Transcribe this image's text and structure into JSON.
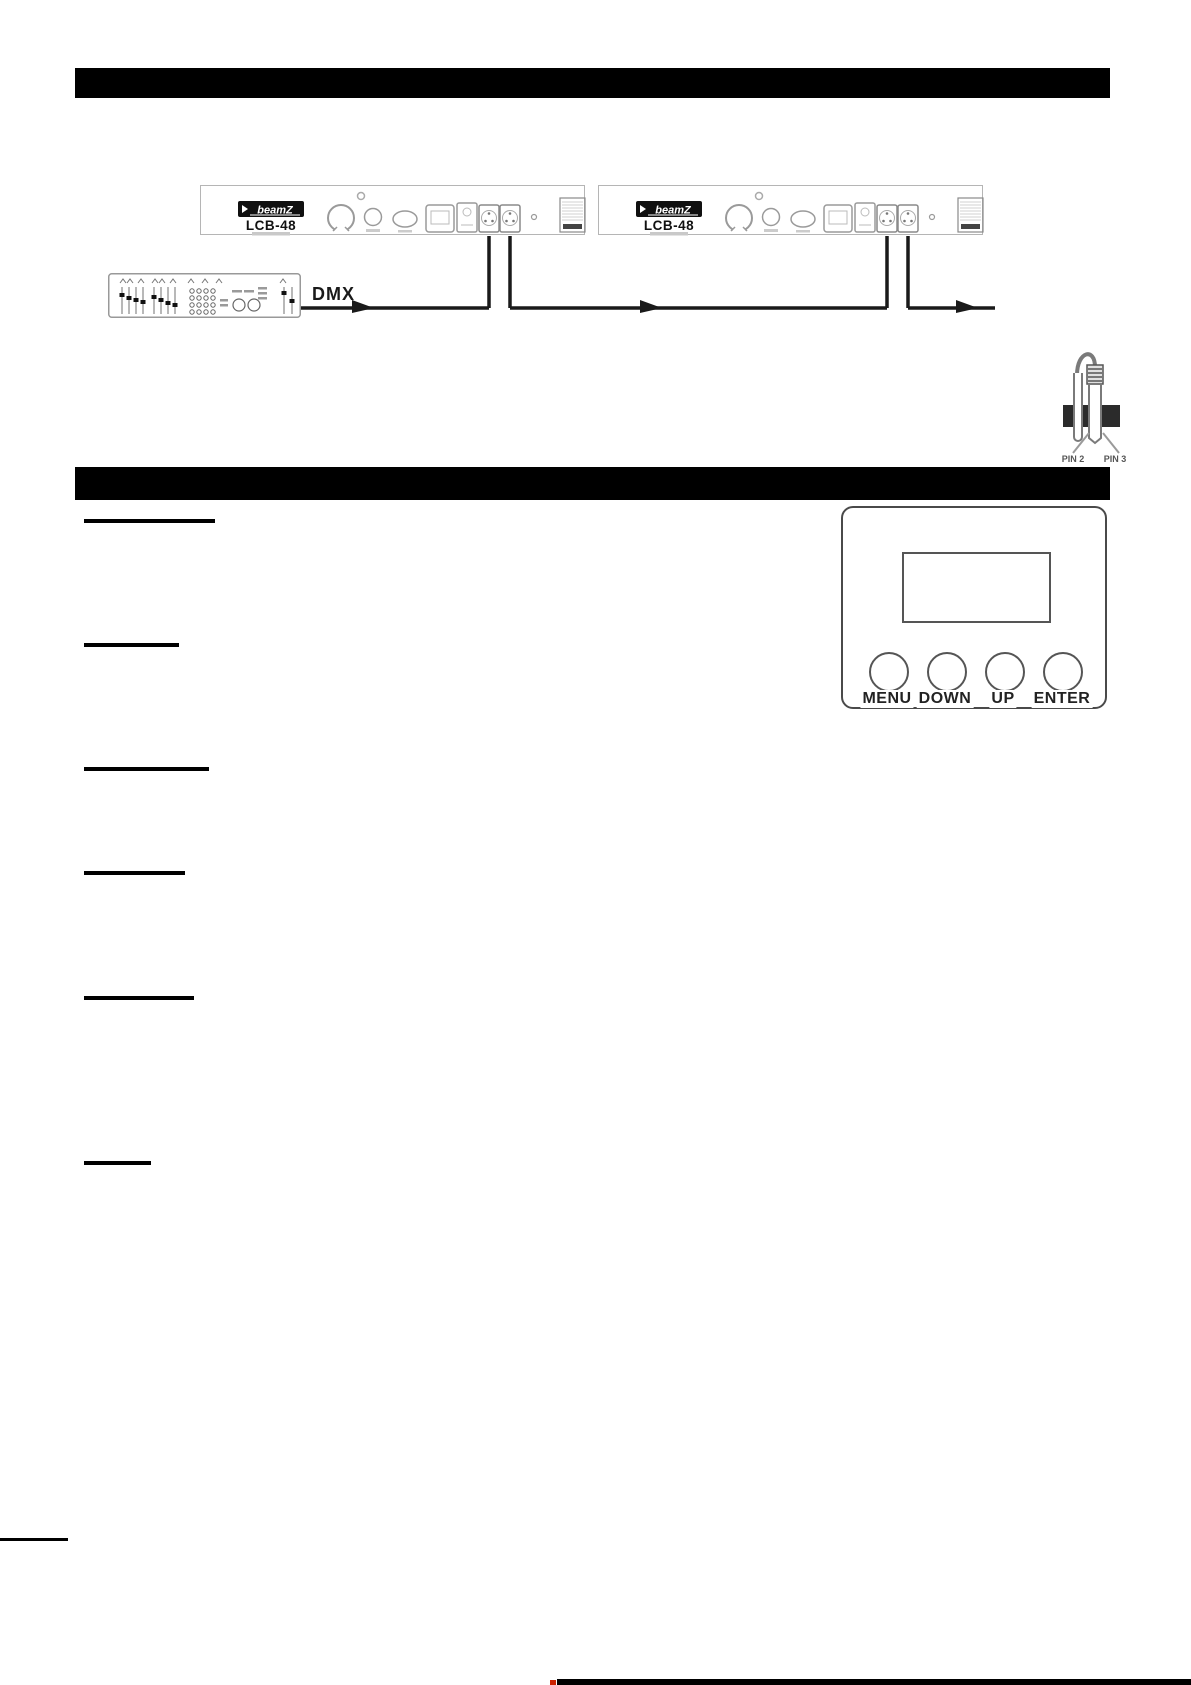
{
  "wiring_diagram": {
    "dmx_label": "DMX",
    "devices": [
      {
        "brand": "beamZ",
        "model": "LCB-48"
      },
      {
        "brand": "beamZ",
        "model": "LCB-48"
      }
    ],
    "terminator": {
      "pin_left_label": "PIN 2",
      "pin_right_label": "PIN 3"
    }
  },
  "control_panel": {
    "button_labels": [
      "MENU",
      "DOWN",
      "UP",
      "ENTER"
    ]
  },
  "colors": {
    "bar_black": "#000000",
    "wire": "#1a1a1a",
    "accent_red": "#cc2200"
  }
}
